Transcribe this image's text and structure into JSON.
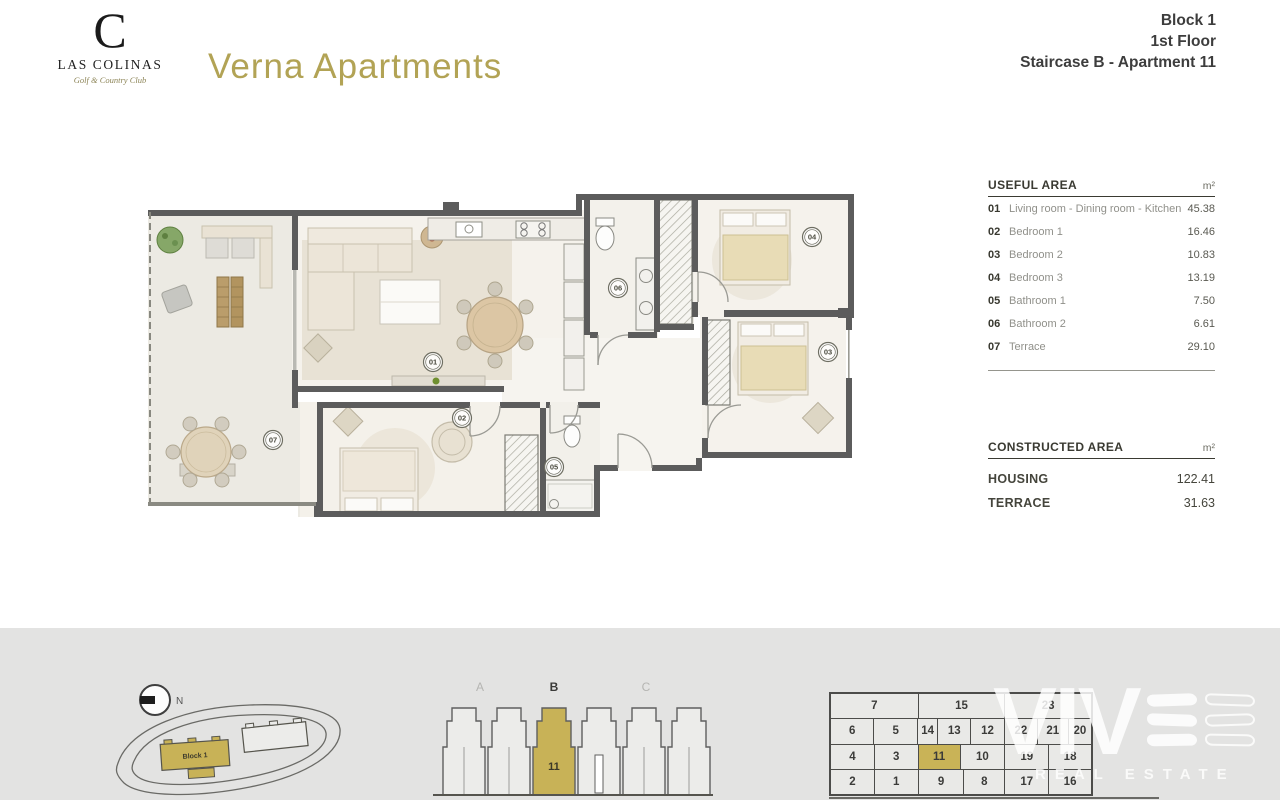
{
  "header": {
    "logo": {
      "monogram": "C",
      "name": "LAS COLINAS",
      "tagline": "Golf & Country Club"
    },
    "title": "Verna Apartments",
    "block_info": {
      "line1": "Block 1",
      "line2": "1st Floor",
      "line3": "Staircase B - Apartment 11"
    }
  },
  "useful_area": {
    "title": "USEFUL AREA",
    "unit": "m²",
    "rows": [
      {
        "num": "01",
        "label": "Living room - Dining room - Kitchen",
        "value": "45.38"
      },
      {
        "num": "02",
        "label": "Bedroom 1",
        "value": "16.46"
      },
      {
        "num": "03",
        "label": "Bedroom 2",
        "value": "10.83"
      },
      {
        "num": "04",
        "label": "Bedroom 3",
        "value": "13.19"
      },
      {
        "num": "05",
        "label": "Bathroom 1",
        "value": "7.50"
      },
      {
        "num": "06",
        "label": "Bathroom 2",
        "value": "6.61"
      },
      {
        "num": "07",
        "label": "Terrace",
        "value": "29.10"
      }
    ]
  },
  "constructed_area": {
    "title": "CONSTRUCTED AREA",
    "unit": "m²",
    "rows": [
      {
        "label": "HOUSING",
        "value": "122.41"
      },
      {
        "label": "TERRACE",
        "value": "31.63"
      }
    ]
  },
  "floor_plan": {
    "room_labels": [
      "01",
      "02",
      "03",
      "04",
      "05",
      "06",
      "07"
    ]
  },
  "site_plan": {
    "north_label": "N",
    "block_label": "Block 1"
  },
  "elevation": {
    "staircases": [
      "A",
      "B",
      "C"
    ],
    "highlight_unit": "11"
  },
  "unit_grid": {
    "highlight": "11",
    "groups": [
      {
        "top": "7",
        "rows": [
          [
            "6",
            "5"
          ],
          [
            "4",
            "3"
          ],
          [
            "2",
            "1"
          ]
        ]
      },
      {
        "top": "15",
        "rows": [
          [
            "14",
            "13",
            "12"
          ],
          [
            "11",
            "10"
          ],
          [
            "9",
            "8"
          ]
        ]
      },
      {
        "top": "23",
        "rows": [
          [
            "22",
            "21",
            "20"
          ],
          [
            "19",
            "18"
          ],
          [
            "17",
            "16"
          ]
        ]
      }
    ]
  },
  "watermark": {
    "letters": "VIV",
    "subtext": "REAL ESTATE"
  },
  "colors": {
    "accent_gold": "#c8b257",
    "title_gold": "#b2a355",
    "wall_gray": "#5c5c5c",
    "strip_gray": "#e3e3e2"
  }
}
